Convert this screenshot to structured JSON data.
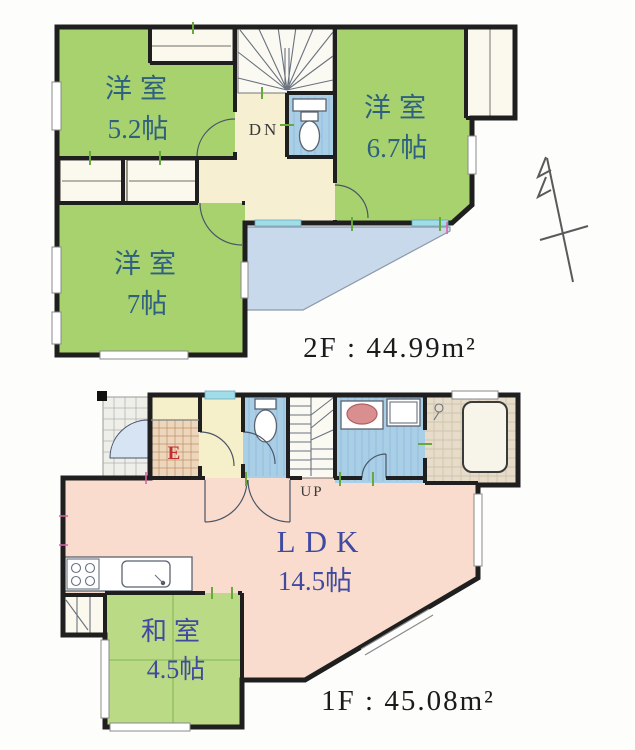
{
  "floor_plan": {
    "floors": [
      {
        "name": "2F",
        "area_label": "2F : 44.99m²",
        "stair_label": "DN",
        "rooms": [
          {
            "type": "洋室",
            "size": "5.2帖"
          },
          {
            "type": "洋室",
            "size": "6.7帖"
          },
          {
            "type": "洋室",
            "size": "7帖"
          }
        ],
        "features": [
          "balcony",
          "toilet",
          "closets",
          "stairs-down"
        ]
      },
      {
        "name": "1F",
        "area_label": "1F : 45.08m²",
        "stair_label": "UP",
        "entrance_label": "E",
        "rooms": [
          {
            "type": "LDK",
            "size": "14.5帖"
          },
          {
            "type": "和室",
            "size": "4.5帖"
          }
        ],
        "features": [
          "entrance-porch",
          "genkan",
          "toilet",
          "washroom",
          "bathroom",
          "kitchen",
          "stairs-up"
        ]
      }
    ],
    "icons": [
      "toilet-icon",
      "bathtub-icon",
      "washbasin-icon",
      "washing-machine-icon",
      "kitchen-sink-icon",
      "stove-icon",
      "stairs-icon",
      "door-swing-icon",
      "north-arrow-icon"
    ],
    "colors": {
      "room-green": "#a8d26e",
      "tatami-green": "#bada85",
      "hall-beige": "#f6efd2",
      "hall-yellow": "#f6f0ca",
      "ldk-pink": "#f9dccd",
      "water-blue": "#a9cfe6",
      "balcony-blue": "#c9d9ec",
      "bath-tan": "#e6dcc9",
      "wall-black": "#1f1f1f",
      "label-teal": "#2e6080",
      "label-indigo": "#3f4aa0",
      "entrance-red": "#c03030",
      "window-cyan": "#9fdde8",
      "tick-green": "#69a83d"
    }
  }
}
